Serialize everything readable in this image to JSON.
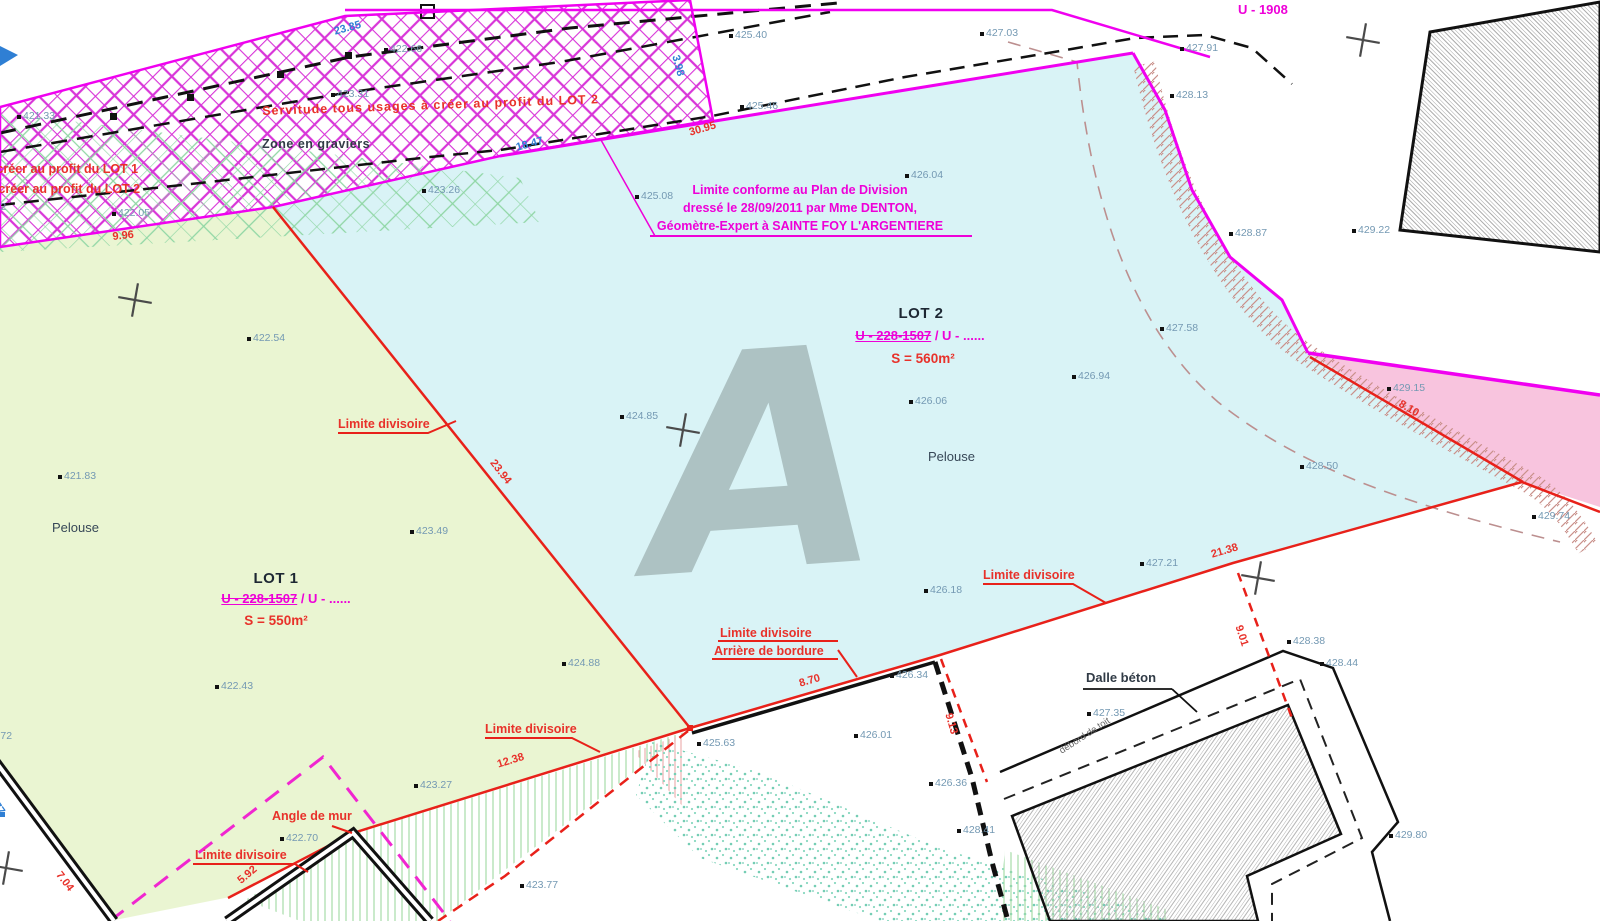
{
  "plan": {
    "watermark": "A",
    "lots": [
      {
        "name": "LOT 1",
        "parcel_strike": "U - 228-1507",
        "parcel_rest": " / U - ......",
        "area": "S = 550m²",
        "ground": "Pelouse",
        "name_cx": 276,
        "name_y": 571,
        "parcel_cx": 286,
        "parcel_y": 592,
        "area_cx": 276,
        "area_y": 614,
        "ground_x": 52,
        "ground_y": 521
      },
      {
        "name": "LOT 2",
        "parcel_strike": "U - 228-1507",
        "parcel_rest": " / U - ......",
        "area": "S = 560m²",
        "ground": "Pelouse",
        "name_cx": 921,
        "name_y": 306,
        "parcel_cx": 920,
        "parcel_y": 329,
        "area_cx": 923,
        "area_y": 352,
        "ground_x": 928,
        "ground_y": 450
      }
    ],
    "note": {
      "cx": 800,
      "lines": [
        {
          "t": "Limite conforme au Plan de Division",
          "y": 184
        },
        {
          "t": "dressé le 28/09/2011 par Mme DENTON,",
          "y": 202
        },
        {
          "t": "Géomètre-Expert à SAINTE FOY L'ARGENTIERE",
          "y": 220
        }
      ]
    },
    "labels": [
      {
        "t": "Servitude tous usages à créer au profit du LOT 2",
        "cls": "lbl-red",
        "x": 262,
        "y": 105,
        "r": -2,
        "ls": 1
      },
      {
        "t": "à créer au profit du LOT 1",
        "cls": "lbl-red",
        "x": -14,
        "y": 163
      },
      {
        "t": "à créer au profit du LOT 2",
        "cls": "lbl-red",
        "x": -12,
        "y": 183
      },
      {
        "t": "Zone en graviers",
        "cls": "lbl-dark",
        "x": 262,
        "y": 138,
        "ls": 0.5
      },
      {
        "t": "U - 1908",
        "cls": "lbl-mag",
        "x": 1238,
        "y": 3,
        "fs": 13
      },
      {
        "t": "Limite divisoire",
        "cls": "lbl-red",
        "x": 338,
        "y": 418
      },
      {
        "t": "Limite divisoire",
        "cls": "lbl-red",
        "x": 983,
        "y": 569
      },
      {
        "t": "Limite divisoire",
        "cls": "lbl-red",
        "x": 720,
        "y": 627
      },
      {
        "t": "Arrière de bordure",
        "cls": "lbl-red",
        "x": 714,
        "y": 645
      },
      {
        "t": "Limite divisoire",
        "cls": "lbl-red",
        "x": 485,
        "y": 723
      },
      {
        "t": "Limite divisoire",
        "cls": "lbl-red",
        "x": 195,
        "y": 849
      },
      {
        "t": "Angle de mur",
        "cls": "lbl-red",
        "x": 272,
        "y": 810
      },
      {
        "t": "Dalle béton",
        "cls": "lbl-dark",
        "x": 1086,
        "y": 671,
        "fs": 13
      },
      {
        "t": "débord de toit",
        "cls": "lbl-gray",
        "x": 1058,
        "y": 748,
        "r": -33
      },
      {
        "t": "Pelouse",
        "cls": "lbl-pelouse",
        "x": 928,
        "y": 450
      },
      {
        "t": "Pelouse",
        "cls": "lbl-pelouse",
        "x": 52,
        "y": 521
      }
    ],
    "elevations": [
      {
        "t": "421.33",
        "x": 23,
        "y": 111
      },
      {
        "t": "422.66",
        "x": 390,
        "y": 44
      },
      {
        "t": "423.31",
        "x": 337,
        "y": 89
      },
      {
        "t": "422.05",
        "x": 118,
        "y": 208
      },
      {
        "t": "422.42",
        "x": -26,
        "y": 202
      },
      {
        "t": "423.26",
        "x": 428,
        "y": 185
      },
      {
        "t": "425.08",
        "x": 641,
        "y": 191
      },
      {
        "t": "426.04",
        "x": 911,
        "y": 170
      },
      {
        "t": "425.40",
        "x": 735,
        "y": 30
      },
      {
        "t": "425.46",
        "x": 746,
        "y": 101
      },
      {
        "t": "427.03",
        "x": 986,
        "y": 28
      },
      {
        "t": "427.91",
        "x": 1186,
        "y": 43
      },
      {
        "t": "428.13",
        "x": 1176,
        "y": 90
      },
      {
        "t": "428.87",
        "x": 1235,
        "y": 228
      },
      {
        "t": "429.22",
        "x": 1358,
        "y": 225
      },
      {
        "t": "427.58",
        "x": 1166,
        "y": 323
      },
      {
        "t": "429.15",
        "x": 1393,
        "y": 383
      },
      {
        "t": "426.94",
        "x": 1078,
        "y": 371
      },
      {
        "t": "426.06",
        "x": 915,
        "y": 396
      },
      {
        "t": "424.85",
        "x": 626,
        "y": 411
      },
      {
        "t": "428.50",
        "x": 1306,
        "y": 461
      },
      {
        "t": "429.74",
        "x": 1538,
        "y": 511
      },
      {
        "t": "427.21",
        "x": 1146,
        "y": 558
      },
      {
        "t": "426.18",
        "x": 930,
        "y": 585
      },
      {
        "t": "422.54",
        "x": 253,
        "y": 333
      },
      {
        "t": "421.83",
        "x": 64,
        "y": 471
      },
      {
        "t": "423.49",
        "x": 416,
        "y": 526
      },
      {
        "t": "422.43",
        "x": 221,
        "y": 681
      },
      {
        "t": "424.88",
        "x": 568,
        "y": 658
      },
      {
        "t": "425.63",
        "x": 703,
        "y": 738
      },
      {
        "t": "426.01",
        "x": 860,
        "y": 730
      },
      {
        "t": "426.34",
        "x": 896,
        "y": 670
      },
      {
        "t": "426.36",
        "x": 935,
        "y": 778
      },
      {
        "t": "428.41",
        "x": 963,
        "y": 825
      },
      {
        "t": "427.35",
        "x": 1093,
        "y": 708
      },
      {
        "t": "428.38",
        "x": 1293,
        "y": 636
      },
      {
        "t": "428.44",
        "x": 1326,
        "y": 658
      },
      {
        "t": "429.80",
        "x": 1395,
        "y": 830
      },
      {
        "t": "423.27",
        "x": 420,
        "y": 780
      },
      {
        "t": "422.70",
        "x": 286,
        "y": 833
      },
      {
        "t": "423.77",
        "x": 526,
        "y": 880
      },
      {
        "t": "421.72",
        "x": -20,
        "y": 731
      }
    ],
    "dimensions": [
      {
        "t": "23.85",
        "x": 333,
        "y": 27,
        "r": -15,
        "c": "b"
      },
      {
        "t": "18.47",
        "x": 515,
        "y": 143,
        "r": -15,
        "c": "b"
      },
      {
        "t": "3.98",
        "x": 680,
        "y": 54,
        "r": 75,
        "c": "b"
      },
      {
        "t": "1.77",
        "x": -6,
        "y": 793,
        "r": 55,
        "c": "b"
      },
      {
        "t": "30.95",
        "x": 688,
        "y": 128,
        "r": -16,
        "c": "r"
      },
      {
        "t": "9.96",
        "x": 112,
        "y": 232,
        "r": -6,
        "c": "r"
      },
      {
        "t": "23.94",
        "x": 496,
        "y": 458,
        "r": 52,
        "c": "r"
      },
      {
        "t": "21.38",
        "x": 1210,
        "y": 550,
        "r": -16,
        "c": "r"
      },
      {
        "t": "8.10",
        "x": 1402,
        "y": 399,
        "r": 30,
        "c": "r"
      },
      {
        "t": "8.70",
        "x": 798,
        "y": 679,
        "r": -16,
        "c": "r"
      },
      {
        "t": "9.13",
        "x": 953,
        "y": 712,
        "r": 74,
        "c": "r"
      },
      {
        "t": "9.01",
        "x": 1243,
        "y": 624,
        "r": 72,
        "c": "r"
      },
      {
        "t": "12.38",
        "x": 496,
        "y": 760,
        "r": -17,
        "c": "r"
      },
      {
        "t": "5.92",
        "x": 236,
        "y": 878,
        "r": -40,
        "c": "r"
      },
      {
        "t": "7.04",
        "x": 62,
        "y": 870,
        "r": 52,
        "c": "r"
      }
    ]
  }
}
